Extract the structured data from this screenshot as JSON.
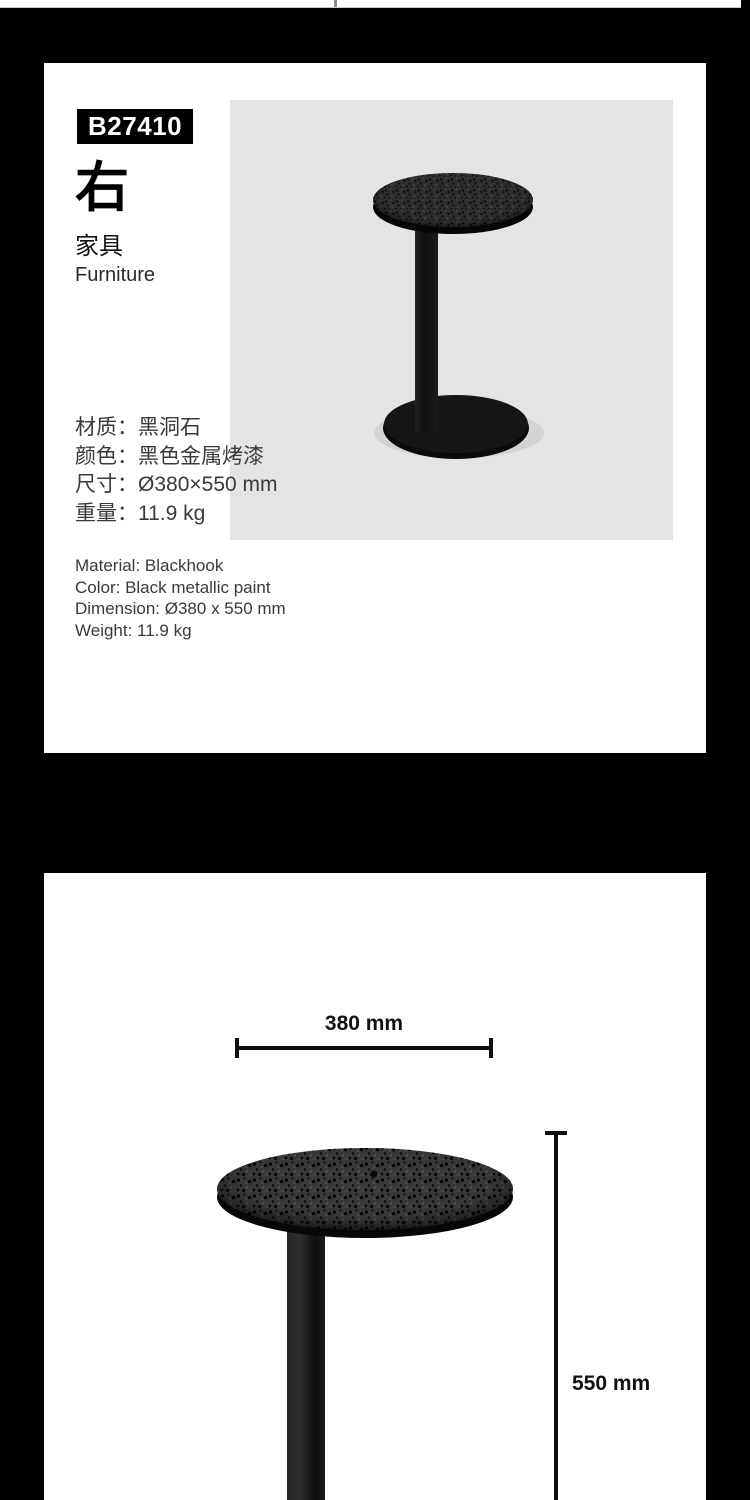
{
  "card1": {
    "sku": "B27410",
    "product_name": "右",
    "category_cn": "家具",
    "category_en": "Furniture",
    "specs_cn": [
      "材质：黑洞石",
      "颜色：黑色金属烤漆",
      "尺寸：Ø380×550 mm",
      "重量：11.9 kg"
    ],
    "specs_en": [
      "Material: Blackhook",
      "Color: Black metallic paint",
      "Dimension: Ø380 x 550 mm",
      "Weight: 11.9 kg"
    ]
  },
  "card2": {
    "width_label": "380 mm",
    "height_label": "550 mm"
  },
  "colors": {
    "page_bg": "#000000",
    "card_bg": "#ffffff",
    "photo_bg": "#e4e4e4",
    "spec_text": "#3a3a3a",
    "dimension_text": "#111111"
  }
}
